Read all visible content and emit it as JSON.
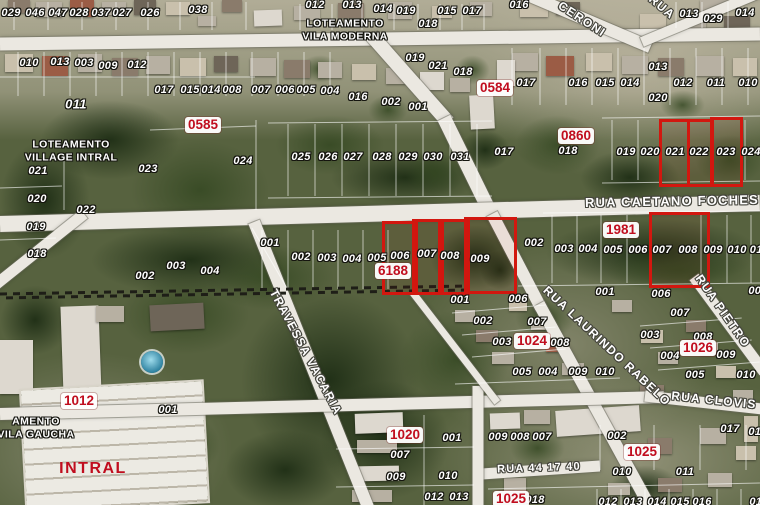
{
  "map": {
    "colors": {
      "highlight": "#d2170f",
      "block_label": "#c00d1e",
      "road": "#ebe8e1"
    },
    "areas": [
      {
        "text": "LOTEAMENTO\nVILA MODERNA",
        "x": 345,
        "y": 30
      },
      {
        "text": "LOTEAMENTO\nVILLAGE INTRAL",
        "x": 71,
        "y": 151
      },
      {
        "text": "AMENTO\nVILA GAUCHA",
        "x": 36,
        "y": 428
      }
    ],
    "factory_label": {
      "text": "INTRAL",
      "x": 93,
      "y": 469
    },
    "streets": [
      {
        "text": "CERONI",
        "x": 582,
        "y": 19,
        "rot": 33,
        "size": 12
      },
      {
        "text": "RUA",
        "x": 662,
        "y": 7,
        "rot": 40,
        "size": 12
      },
      {
        "text": "RUA CAETANO FOCHES",
        "x": 672,
        "y": 201,
        "rot": -1,
        "size": 13
      },
      {
        "text": "TRAVESSA VACARIA",
        "x": 306,
        "y": 352,
        "rot": 62,
        "size": 12
      },
      {
        "text": "RUA LAURINDO RABELO",
        "x": 607,
        "y": 346,
        "rot": 43,
        "size": 12
      },
      {
        "text": "RUA PIETRO",
        "x": 723,
        "y": 311,
        "rot": 55,
        "size": 12
      },
      {
        "text": "RUA CLOVIS",
        "x": 714,
        "y": 400,
        "rot": 6,
        "size": 12
      },
      {
        "text": "RUA 44 17 40",
        "x": 539,
        "y": 468,
        "rot": -2,
        "size": 11
      }
    ],
    "blocks": [
      {
        "text": "0584",
        "x": 495,
        "y": 88
      },
      {
        "text": "0585",
        "x": 203,
        "y": 125
      },
      {
        "text": "0860",
        "x": 576,
        "y": 136
      },
      {
        "text": "1981",
        "x": 621,
        "y": 230
      },
      {
        "text": "6188",
        "x": 393,
        "y": 271
      },
      {
        "text": "1012",
        "x": 79,
        "y": 401
      },
      {
        "text": "1020",
        "x": 405,
        "y": 435
      },
      {
        "text": "1024",
        "x": 532,
        "y": 341
      },
      {
        "text": "1026",
        "x": 698,
        "y": 348
      },
      {
        "text": "1025",
        "x": 642,
        "y": 452
      },
      {
        "text": "1025",
        "x": 511,
        "y": 499
      }
    ],
    "highlights": [
      {
        "x": 659,
        "y": 119,
        "w": 25,
        "h": 62
      },
      {
        "x": 687,
        "y": 119,
        "w": 21,
        "h": 62
      },
      {
        "x": 710,
        "y": 117,
        "w": 27,
        "h": 64
      },
      {
        "x": 382,
        "y": 221,
        "w": 30,
        "h": 68
      },
      {
        "x": 412,
        "y": 219,
        "w": 26,
        "h": 70
      },
      {
        "x": 438,
        "y": 219,
        "w": 26,
        "h": 70
      },
      {
        "x": 464,
        "y": 217,
        "w": 47,
        "h": 71
      },
      {
        "x": 649,
        "y": 212,
        "w": 55,
        "h": 70
      }
    ],
    "lots": [
      {
        "text": "029",
        "x": 11,
        "y": 13
      },
      {
        "text": "046",
        "x": 35,
        "y": 13
      },
      {
        "text": "047",
        "x": 58,
        "y": 13
      },
      {
        "text": "028",
        "x": 79,
        "y": 13
      },
      {
        "text": "037",
        "x": 101,
        "y": 13
      },
      {
        "text": "027",
        "x": 122,
        "y": 13
      },
      {
        "text": "026",
        "x": 150,
        "y": 13
      },
      {
        "text": "038",
        "x": 198,
        "y": 10
      },
      {
        "text": "012",
        "x": 315,
        "y": 5
      },
      {
        "text": "013",
        "x": 352,
        "y": 5
      },
      {
        "text": "014",
        "x": 383,
        "y": 9
      },
      {
        "text": "019",
        "x": 406,
        "y": 11
      },
      {
        "text": "015",
        "x": 447,
        "y": 11
      },
      {
        "text": "017",
        "x": 472,
        "y": 11
      },
      {
        "text": "016",
        "x": 519,
        "y": 5
      },
      {
        "text": "018",
        "x": 428,
        "y": 24
      },
      {
        "text": "013",
        "x": 689,
        "y": 14
      },
      {
        "text": "029",
        "x": 713,
        "y": 19
      },
      {
        "text": "014",
        "x": 745,
        "y": 13
      },
      {
        "text": "010",
        "x": 29,
        "y": 63
      },
      {
        "text": "013",
        "x": 60,
        "y": 62
      },
      {
        "text": "003",
        "x": 84,
        "y": 63
      },
      {
        "text": "009",
        "x": 108,
        "y": 66
      },
      {
        "text": "012",
        "x": 137,
        "y": 65
      },
      {
        "text": "017",
        "x": 164,
        "y": 90
      },
      {
        "text": "015",
        "x": 190,
        "y": 90
      },
      {
        "text": "014",
        "x": 211,
        "y": 90
      },
      {
        "text": "008",
        "x": 232,
        "y": 90
      },
      {
        "text": "007",
        "x": 261,
        "y": 90
      },
      {
        "text": "006",
        "x": 285,
        "y": 90
      },
      {
        "text": "005",
        "x": 306,
        "y": 90
      },
      {
        "text": "004",
        "x": 330,
        "y": 91
      },
      {
        "text": "016",
        "x": 358,
        "y": 97
      },
      {
        "text": "002",
        "x": 391,
        "y": 102
      },
      {
        "text": "001",
        "x": 418,
        "y": 107
      },
      {
        "text": "011",
        "x": 76,
        "y": 104,
        "size": 13
      },
      {
        "text": "019",
        "x": 415,
        "y": 58
      },
      {
        "text": "021",
        "x": 438,
        "y": 66
      },
      {
        "text": "018",
        "x": 463,
        "y": 72
      },
      {
        "text": "013",
        "x": 658,
        "y": 67
      },
      {
        "text": "017",
        "x": 526,
        "y": 83
      },
      {
        "text": "016",
        "x": 578,
        "y": 83
      },
      {
        "text": "015",
        "x": 605,
        "y": 83
      },
      {
        "text": "014",
        "x": 630,
        "y": 83
      },
      {
        "text": "012",
        "x": 683,
        "y": 83
      },
      {
        "text": "011",
        "x": 716,
        "y": 83
      },
      {
        "text": "010",
        "x": 748,
        "y": 83
      },
      {
        "text": "020",
        "x": 658,
        "y": 98
      },
      {
        "text": "021",
        "x": 38,
        "y": 171
      },
      {
        "text": "023",
        "x": 148,
        "y": 169
      },
      {
        "text": "024",
        "x": 243,
        "y": 161
      },
      {
        "text": "020",
        "x": 37,
        "y": 199
      },
      {
        "text": "022",
        "x": 86,
        "y": 210
      },
      {
        "text": "019",
        "x": 36,
        "y": 227
      },
      {
        "text": "018",
        "x": 37,
        "y": 254
      },
      {
        "text": "025",
        "x": 301,
        "y": 157
      },
      {
        "text": "026",
        "x": 328,
        "y": 157
      },
      {
        "text": "027",
        "x": 353,
        "y": 157
      },
      {
        "text": "028",
        "x": 382,
        "y": 157
      },
      {
        "text": "029",
        "x": 408,
        "y": 157
      },
      {
        "text": "030",
        "x": 433,
        "y": 157
      },
      {
        "text": "031",
        "x": 460,
        "y": 157
      },
      {
        "text": "017",
        "x": 504,
        "y": 152
      },
      {
        "text": "018",
        "x": 568,
        "y": 151
      },
      {
        "text": "019",
        "x": 626,
        "y": 152
      },
      {
        "text": "020",
        "x": 650,
        "y": 152
      },
      {
        "text": "021",
        "x": 675,
        "y": 152
      },
      {
        "text": "022",
        "x": 699,
        "y": 152
      },
      {
        "text": "023",
        "x": 726,
        "y": 152
      },
      {
        "text": "024",
        "x": 751,
        "y": 152
      },
      {
        "text": "001",
        "x": 270,
        "y": 243
      },
      {
        "text": "002",
        "x": 301,
        "y": 257
      },
      {
        "text": "003",
        "x": 327,
        "y": 258
      },
      {
        "text": "004",
        "x": 352,
        "y": 259
      },
      {
        "text": "005",
        "x": 377,
        "y": 258
      },
      {
        "text": "006",
        "x": 400,
        "y": 256
      },
      {
        "text": "007",
        "x": 427,
        "y": 254
      },
      {
        "text": "008",
        "x": 450,
        "y": 256
      },
      {
        "text": "009",
        "x": 480,
        "y": 259
      },
      {
        "text": "002",
        "x": 145,
        "y": 276
      },
      {
        "text": "003",
        "x": 176,
        "y": 266
      },
      {
        "text": "004",
        "x": 210,
        "y": 271
      },
      {
        "text": "002",
        "x": 534,
        "y": 243
      },
      {
        "text": "003",
        "x": 564,
        "y": 249
      },
      {
        "text": "004",
        "x": 588,
        "y": 249
      },
      {
        "text": "005",
        "x": 613,
        "y": 250
      },
      {
        "text": "006",
        "x": 638,
        "y": 250
      },
      {
        "text": "007",
        "x": 662,
        "y": 250
      },
      {
        "text": "008",
        "x": 688,
        "y": 250
      },
      {
        "text": "009",
        "x": 713,
        "y": 250
      },
      {
        "text": "010",
        "x": 737,
        "y": 250
      },
      {
        "text": "011",
        "x": 759,
        "y": 250
      },
      {
        "text": "006",
        "x": 518,
        "y": 299
      },
      {
        "text": "001",
        "x": 605,
        "y": 292
      },
      {
        "text": "006",
        "x": 661,
        "y": 294
      },
      {
        "text": "007",
        "x": 758,
        "y": 291
      },
      {
        "text": "001",
        "x": 460,
        "y": 300
      },
      {
        "text": "002",
        "x": 483,
        "y": 321
      },
      {
        "text": "007",
        "x": 537,
        "y": 322
      },
      {
        "text": "003",
        "x": 502,
        "y": 342
      },
      {
        "text": "008",
        "x": 560,
        "y": 343
      },
      {
        "text": "005",
        "x": 522,
        "y": 372
      },
      {
        "text": "004",
        "x": 548,
        "y": 372
      },
      {
        "text": "009",
        "x": 578,
        "y": 372
      },
      {
        "text": "010",
        "x": 605,
        "y": 372
      },
      {
        "text": "007",
        "x": 680,
        "y": 313
      },
      {
        "text": "003",
        "x": 650,
        "y": 335
      },
      {
        "text": "008",
        "x": 703,
        "y": 337
      },
      {
        "text": "009",
        "x": 726,
        "y": 355
      },
      {
        "text": "004",
        "x": 670,
        "y": 356
      },
      {
        "text": "005",
        "x": 695,
        "y": 375
      },
      {
        "text": "010",
        "x": 746,
        "y": 375
      },
      {
        "text": "001",
        "x": 168,
        "y": 410
      },
      {
        "text": "001",
        "x": 452,
        "y": 438
      },
      {
        "text": "007",
        "x": 400,
        "y": 455
      },
      {
        "text": "009",
        "x": 396,
        "y": 477
      },
      {
        "text": "010",
        "x": 448,
        "y": 476
      },
      {
        "text": "012",
        "x": 434,
        "y": 497
      },
      {
        "text": "013",
        "x": 459,
        "y": 497
      },
      {
        "text": "009",
        "x": 498,
        "y": 437
      },
      {
        "text": "008",
        "x": 520,
        "y": 437
      },
      {
        "text": "007",
        "x": 542,
        "y": 437
      },
      {
        "text": "002",
        "x": 617,
        "y": 436
      },
      {
        "text": "010",
        "x": 622,
        "y": 472
      },
      {
        "text": "011",
        "x": 685,
        "y": 472
      },
      {
        "text": "018",
        "x": 535,
        "y": 500
      },
      {
        "text": "012",
        "x": 608,
        "y": 502
      },
      {
        "text": "013",
        "x": 633,
        "y": 502
      },
      {
        "text": "014",
        "x": 657,
        "y": 502
      },
      {
        "text": "015",
        "x": 680,
        "y": 502
      },
      {
        "text": "016",
        "x": 702,
        "y": 502
      },
      {
        "text": "017",
        "x": 730,
        "y": 429
      },
      {
        "text": "016",
        "x": 758,
        "y": 432
      },
      {
        "text": "017",
        "x": 759,
        "y": 502
      }
    ]
  }
}
